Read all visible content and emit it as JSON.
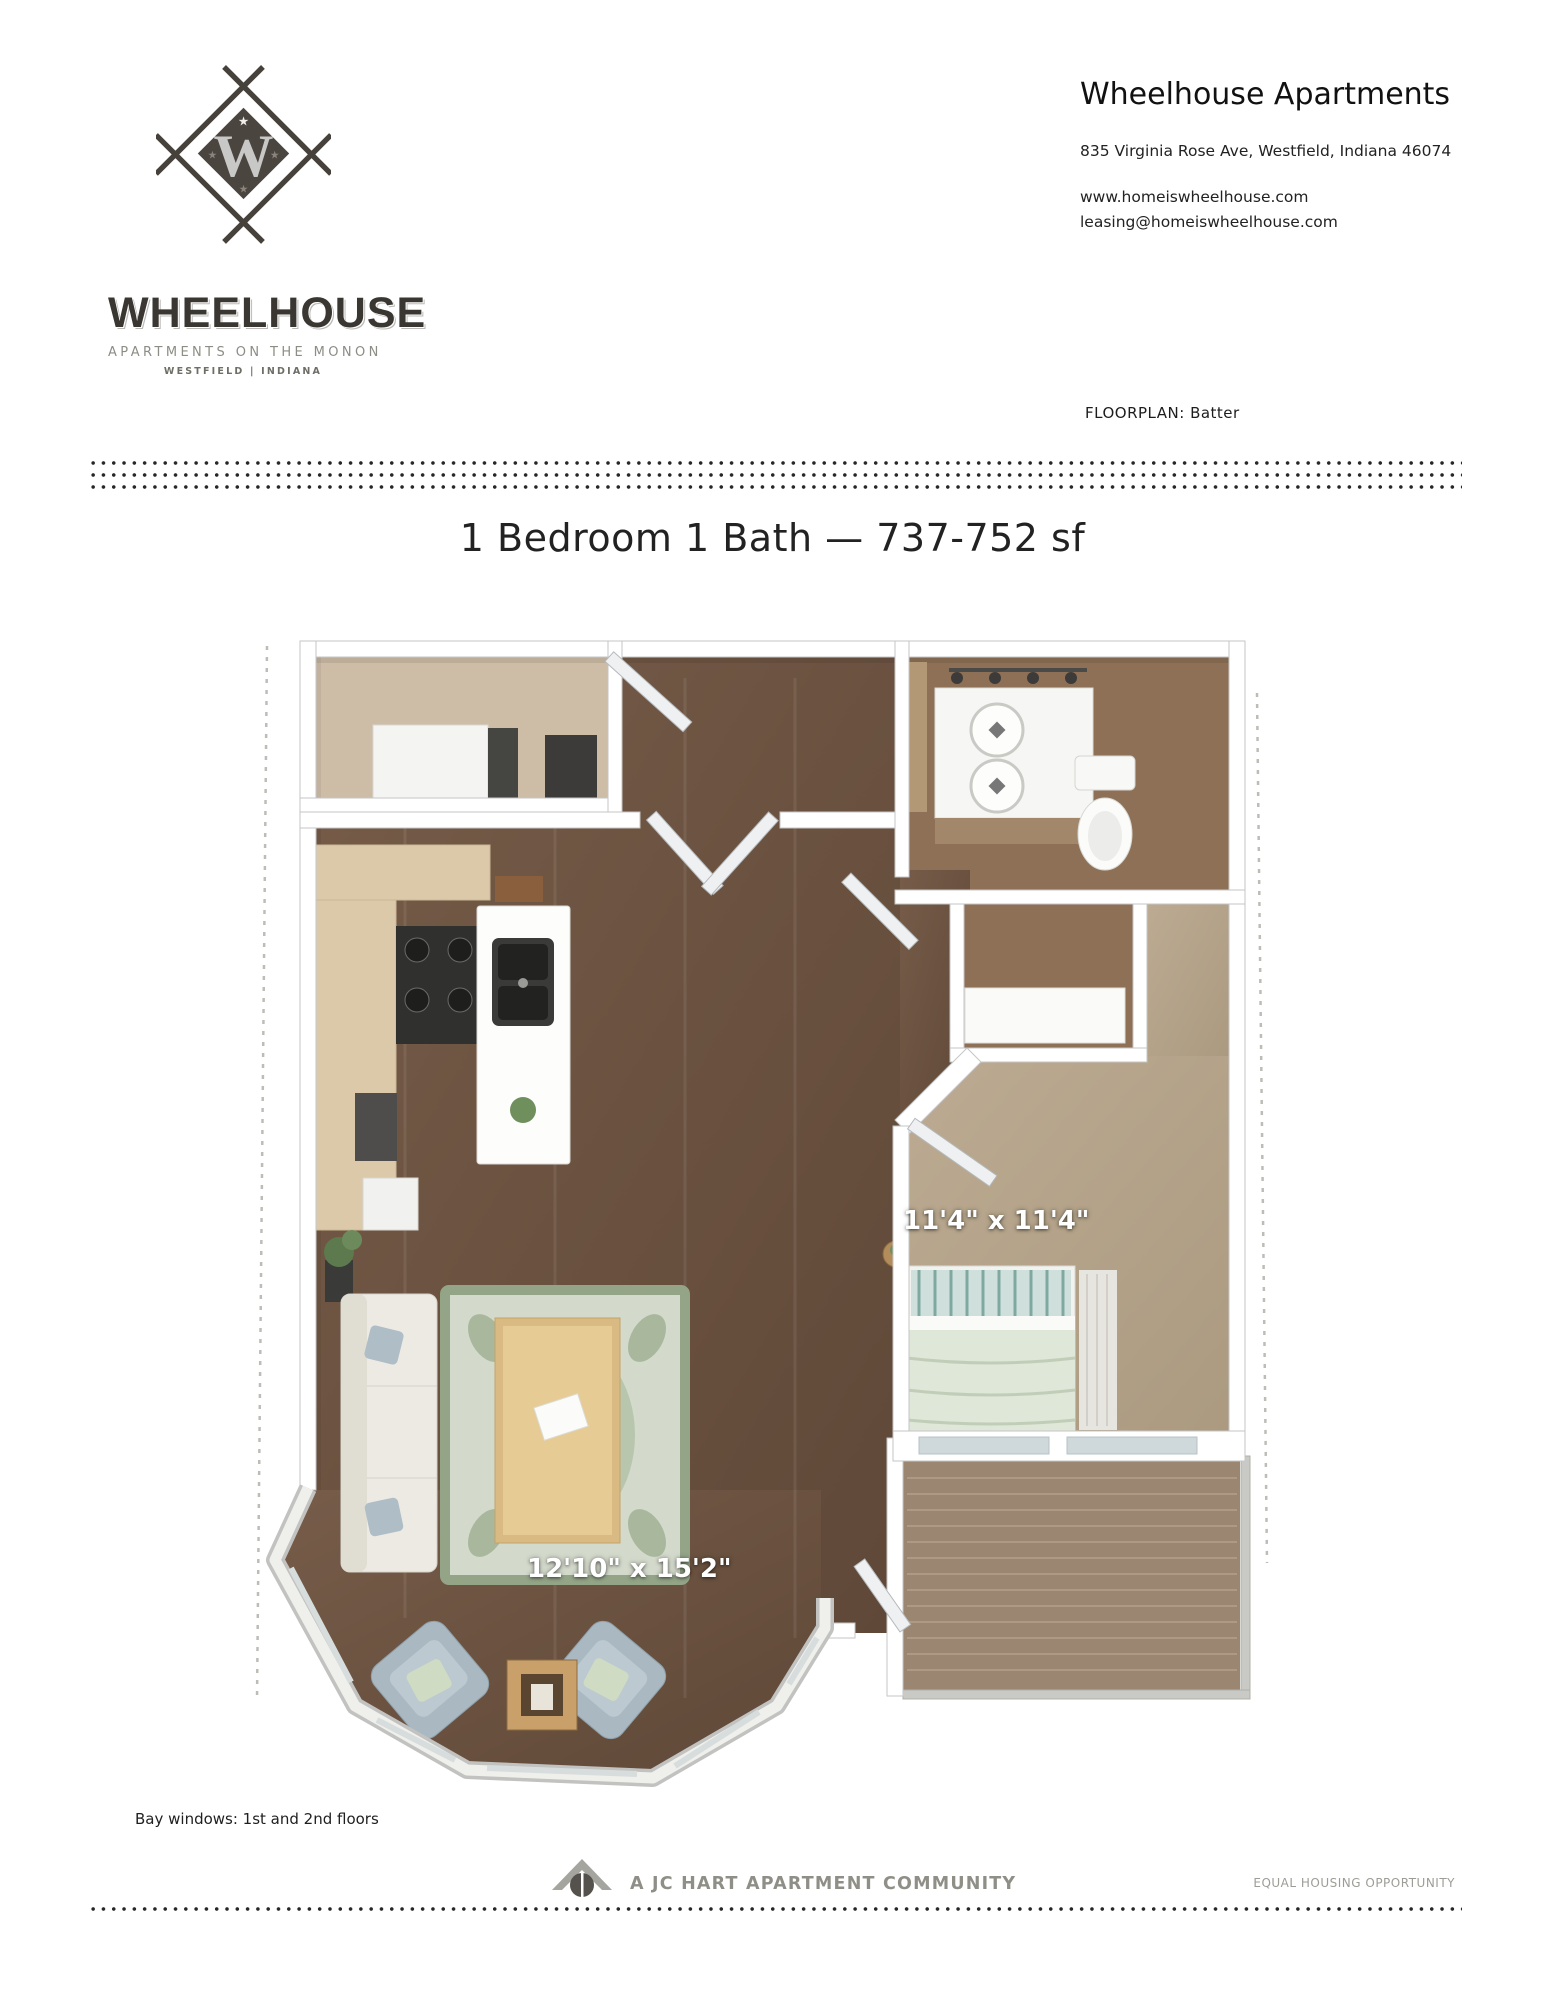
{
  "logo": {
    "monogram": "W",
    "wordmark": "WHEELHOUSE",
    "tagline": "APARTMENTS ON THE MONON",
    "location": "WESTFIELD | INDIANA"
  },
  "contact": {
    "title": "Wheelhouse Apartments",
    "address": "835 Virginia Rose Ave, Westfield, Indiana 46074",
    "website": "www.homeiswheelhouse.com",
    "email": "leasing@homeiswheelhouse.com",
    "floorplan_label": "FLOORPLAN:",
    "floorplan_name": "Batter"
  },
  "plan": {
    "title": "1 Bedroom 1 Bath — 737-752 sf",
    "bedroom_dim": "11'4\" x 11'4\"",
    "living_dim": "12'10\" x 15'2\"",
    "note": "Bay windows: 1st and 2nd floors"
  },
  "footer": {
    "community": "A JC HART APARTMENT COMMUNITY",
    "equal_housing": "EQUAL HOUSING OPPORTUNITY"
  },
  "colors": {
    "logo_dark": "#3a3631",
    "dot": "#262626",
    "wood_floor": "#6e5543",
    "bedroom_carpet": "#b6a68d",
    "balcony_deck": "#9b8671"
  }
}
